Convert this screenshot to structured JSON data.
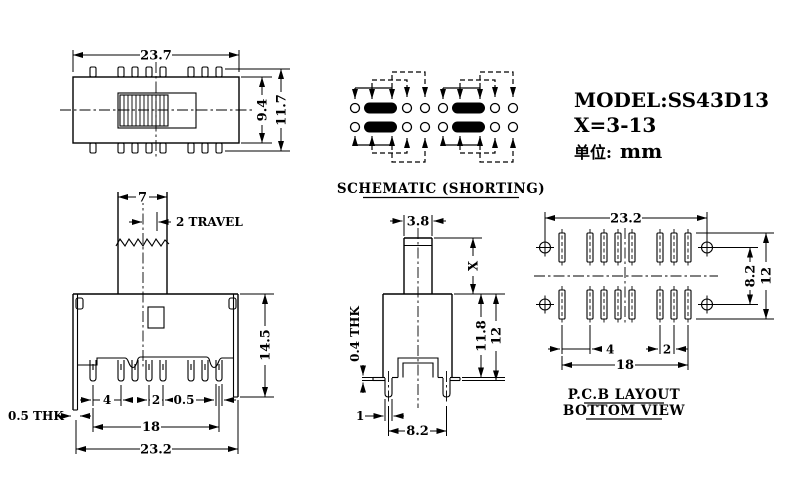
{
  "info": {
    "model": "MODEL:SS43D13",
    "x_value": "X=3-13",
    "unit_label": "单位:",
    "unit_value": "mm"
  },
  "schematic": {
    "title": "SCHEMATIC (SHORTING)"
  },
  "top_view": {
    "dim_width": "23.7",
    "dim_body_height": "9.4",
    "dim_overall_height": "11.7"
  },
  "front_view": {
    "dim_knob_width": "7",
    "dim_travel": "2 TRAVEL",
    "dim_height": "14.5",
    "dim_plate_thickness": "0.5 THK",
    "dim_pitch4": "4",
    "dim_pitch2": "2",
    "dim_pin_width": "0.5",
    "dim_pin_span": "18",
    "dim_overall_width": "23.2"
  },
  "side_view": {
    "dim_stem_width": "3.8",
    "dim_stem_height": "X",
    "dim_body_height": "11.8",
    "dim_overall_height": "12",
    "dim_metal_thickness": "0.4 THK",
    "dim_leg_width": "1",
    "dim_leg_span": "8.2"
  },
  "pcb": {
    "title_line1": "P.C.B LAYOUT",
    "title_line2": "BOTTOM VIEW",
    "dim_hole_span": "23.2",
    "dim_row_pitch": "8.2",
    "dim_height": "12",
    "dim_pitch4": "4",
    "dim_pitch2": "2",
    "dim_span": "18"
  }
}
